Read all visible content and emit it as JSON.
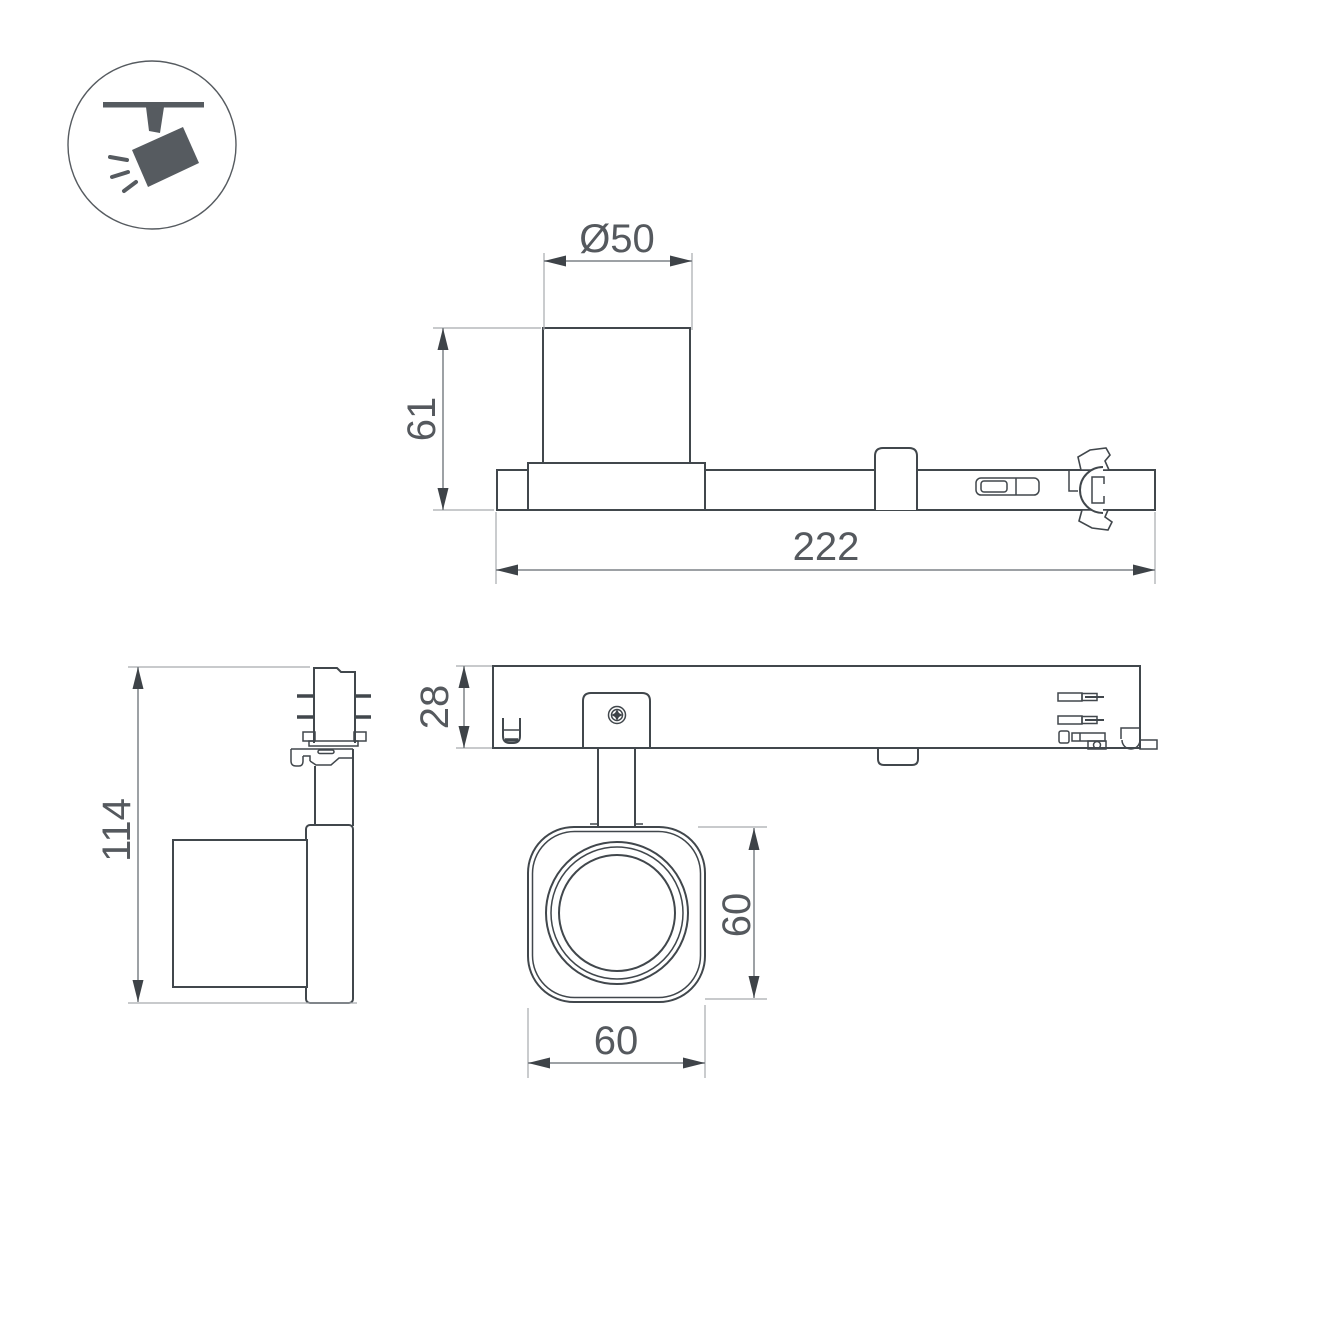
{
  "drawing": {
    "type": "technical-dimension-drawing",
    "subject": "ceiling track spotlight luminaire",
    "background": "#ffffff",
    "colors": {
      "object_line": "#41474c",
      "dimension_line": "#7d8287",
      "extension_line": "#a6aaae",
      "arrow": "#3e4348",
      "text": "#55595e",
      "icon": "#565b60"
    },
    "dimensions": {
      "head_diameter": "Ø50",
      "head_height": "61",
      "total_length": "222",
      "track_height": "28",
      "total_height": "114",
      "face_height": "60",
      "face_width": "60"
    },
    "icon": {
      "label": "track-spotlight-pictogram"
    }
  }
}
